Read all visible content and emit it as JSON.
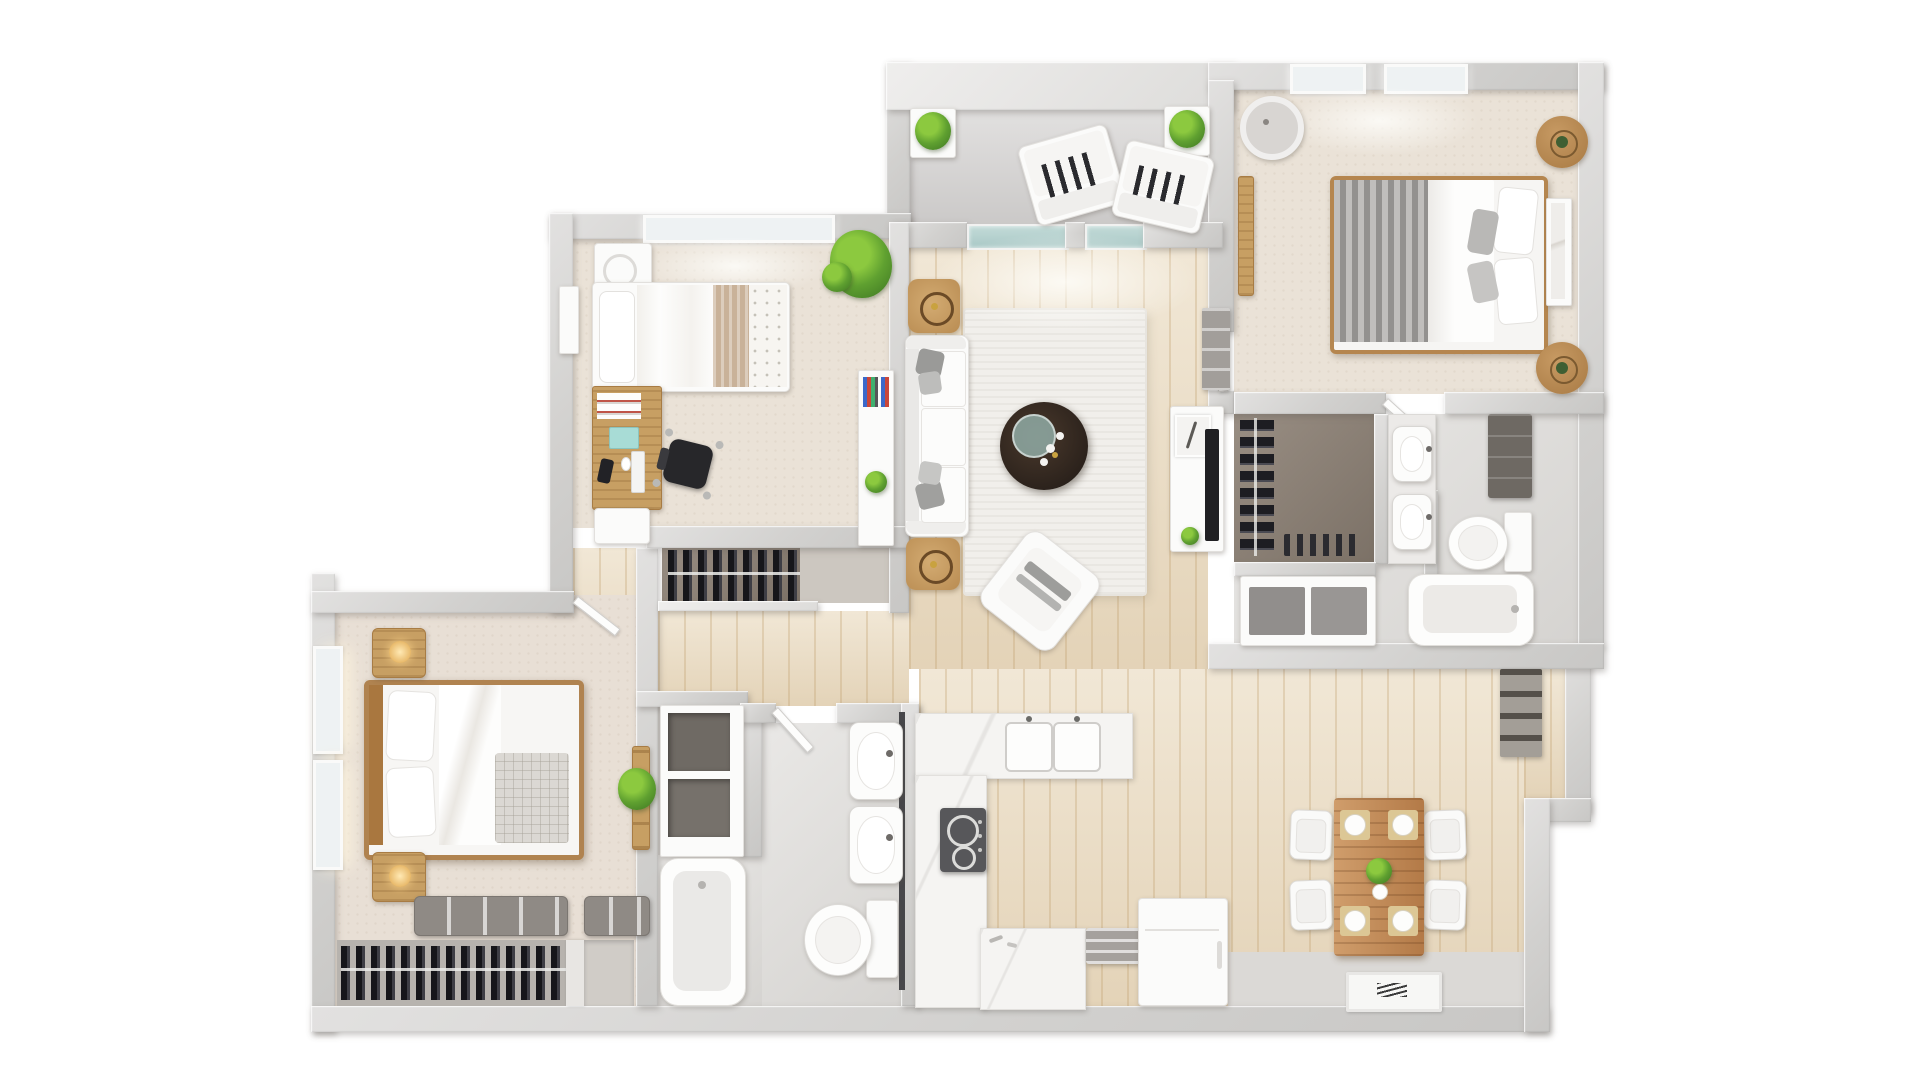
{
  "scene": {
    "type": "3d-floor-plan-render",
    "view": "top-down",
    "background": "#ffffff"
  },
  "palette": {
    "wall": "#d2d1cf",
    "wood_floor": "#ebddc4",
    "carpet_bedroom": "#eae2d7",
    "carpet_master": "#e8dfd5",
    "balcony_floor": "#d6d4d3",
    "bath_tile": "#dedcd9",
    "closet_floor": "#8d8175",
    "rug": "#f1efeb",
    "marble_counter": "#f5f4f2",
    "wood_accent": "#c79f63",
    "dining_wood": "#c08550",
    "coffee_table_dark": "#362a22",
    "plant_green": "#5fa030",
    "fabric_white": "#fbfbfa",
    "blanket_gray": "#8f8d8b",
    "clothes_dark": "#1d1d22",
    "stove_dark": "#57575a",
    "glass_door": "#b5d0cd"
  },
  "rooms": {
    "balcony": {
      "name": "Balcony",
      "furniture": [
        "lounge chair",
        "lounge chair",
        "planter box",
        "planter box"
      ]
    },
    "bedroom_2": {
      "name": "Bedroom 2",
      "windows": 2,
      "furniture": [
        "double bed",
        "gray blanket",
        "wicker nightstand",
        "wicker nightstand",
        "ceiling fan",
        "leaning wall art",
        "wall bench"
      ]
    },
    "bathroom_1": {
      "name": "Bathroom 1",
      "furniture": [
        "walk-in closet rod",
        "shoe row",
        "double sink counter",
        "toilet",
        "dresser",
        "vanity cabinet",
        "bathtub"
      ]
    },
    "bedroom_3": {
      "name": "Bedroom 3 / Office",
      "windows": 1,
      "furniture": [
        "single bed",
        "desk",
        "office chair",
        "washer cabinet",
        "bookshelf console",
        "potted plant",
        "wall art",
        "small cabinet",
        "closet rod",
        "closet mat"
      ]
    },
    "living_room": {
      "name": "Living Room",
      "furniture": [
        "sectional sofa",
        "wicker side table",
        "wicker side table",
        "round coffee table",
        "accent armchair",
        "area rug",
        "tv console",
        "feather wall art",
        "wall shelf cabinet",
        "sliding glass door"
      ]
    },
    "master_bedroom": {
      "name": "Master Bedroom",
      "windows": 2,
      "furniture": [
        "double bed",
        "nightstand with lamp",
        "nightstand with lamp",
        "storage bench",
        "storage bench",
        "closet rod",
        "ladder shelf",
        "potted plant"
      ]
    },
    "hallway": {
      "name": "Hallway",
      "furniture": [
        "linen cubbies"
      ]
    },
    "bathroom_2": {
      "name": "Bathroom 2",
      "furniture": [
        "sink",
        "sink",
        "toilet",
        "bathtub"
      ]
    },
    "kitchen": {
      "name": "Kitchen",
      "furniture": [
        "double sink counter",
        "cooktop",
        "side counter",
        "bottom counter",
        "dish rack",
        "kitchen cart"
      ]
    },
    "dining": {
      "name": "Dining Area",
      "furniture": [
        "dining table",
        "dining chair",
        "dining chair",
        "dining chair",
        "dining chair",
        "place setting",
        "place setting",
        "place setting",
        "place setting",
        "centerpiece plant",
        "doormat",
        "pantry shelf"
      ]
    }
  }
}
